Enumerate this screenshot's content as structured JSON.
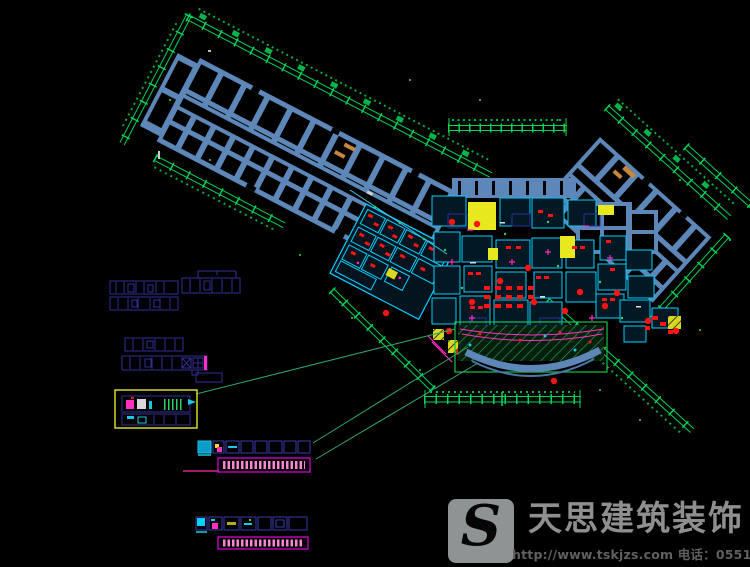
{
  "watermark": {
    "logo_letter": "S",
    "company_name": "天思建筑装饰",
    "contact_line": "http://www.tskjzs.com 电话：0551-65568226"
  },
  "palette": {
    "background": "#000000",
    "wall_blue": "#5d87b8",
    "dimension_green": "#00d455",
    "leader_green": "#2fa36b",
    "detail_cyan": "#00cfff",
    "outline_navy": "#2f2f96",
    "highlight_yellow": "#e8e81e",
    "furniture_red": "#ff1414",
    "accent_magenta": "#ff30c0",
    "text_pink": "#ff85d5",
    "stair_tan": "#c8863c",
    "legend_border_yellow": "#d8d82a",
    "watermark_gray": "#8f8f8f"
  }
}
